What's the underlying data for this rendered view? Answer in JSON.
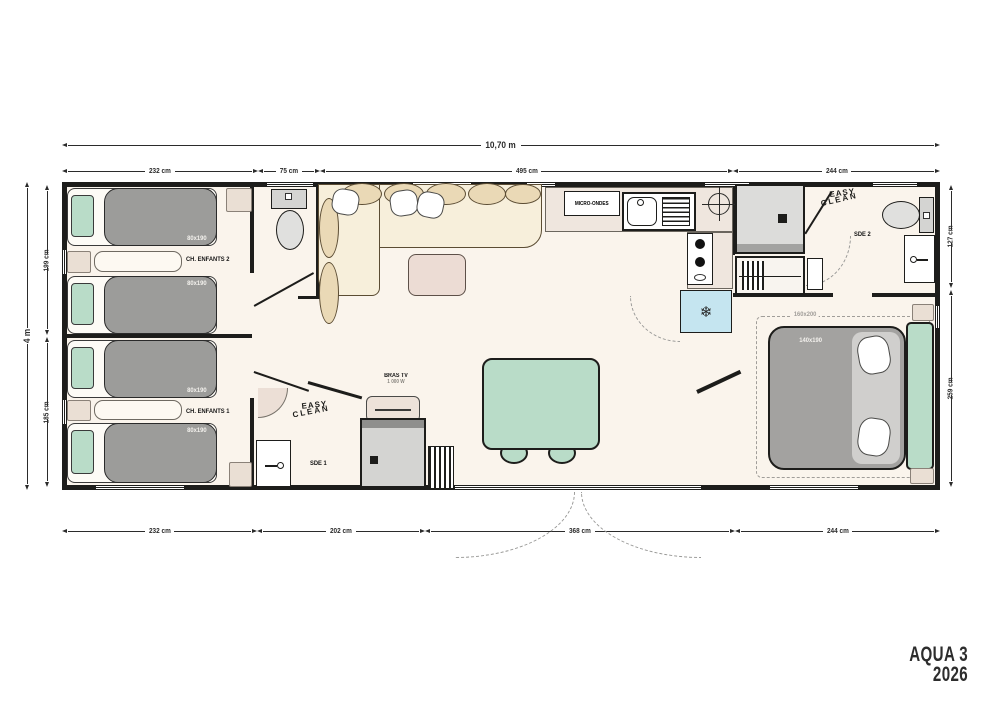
{
  "plan": {
    "model": "AQUA 3",
    "year": "2026",
    "overall": {
      "width": "10,70 m",
      "height": "4 m"
    },
    "dims_top": [
      "232 cm",
      "75 cm",
      "495 cm",
      "244 cm"
    ],
    "dims_bottom": [
      "232 cm",
      "202 cm",
      "368 cm",
      "244 cm"
    ],
    "dims_left": [
      "199 cm",
      "185 cm"
    ],
    "dims_right": [
      "127 cm",
      "259 cm"
    ],
    "rooms": {
      "kids_bedroom_2": "CH. ENFANTS 2",
      "kids_bedroom_1": "CH. ENFANTS 1",
      "shower_room_1": "SDE 1",
      "shower_room_2": "SDE 2"
    },
    "furniture": {
      "single_bed_size": "80x190",
      "double_bed_size": "140x190",
      "double_bed_option_size": "160x200",
      "microwave": "MICRO-ONDES",
      "tv_bracket_line1": "BRAS TV",
      "tv_bracket_line2": "1 000 W"
    },
    "branding": {
      "easy_clean_word1": "EASY",
      "easy_clean_word2": "CLEAN"
    },
    "colors": {
      "wall": "#1d1d1b",
      "floor": "#faf4ec",
      "bed_gray": "#9c9c9a",
      "mint_green": "#b9dcc8",
      "sofa_cream": "#f7efdb",
      "cushion_tan": "#ead9b6",
      "fridge_blue": "#c5e5f0",
      "accent_beige": "#eadfd4"
    }
  }
}
